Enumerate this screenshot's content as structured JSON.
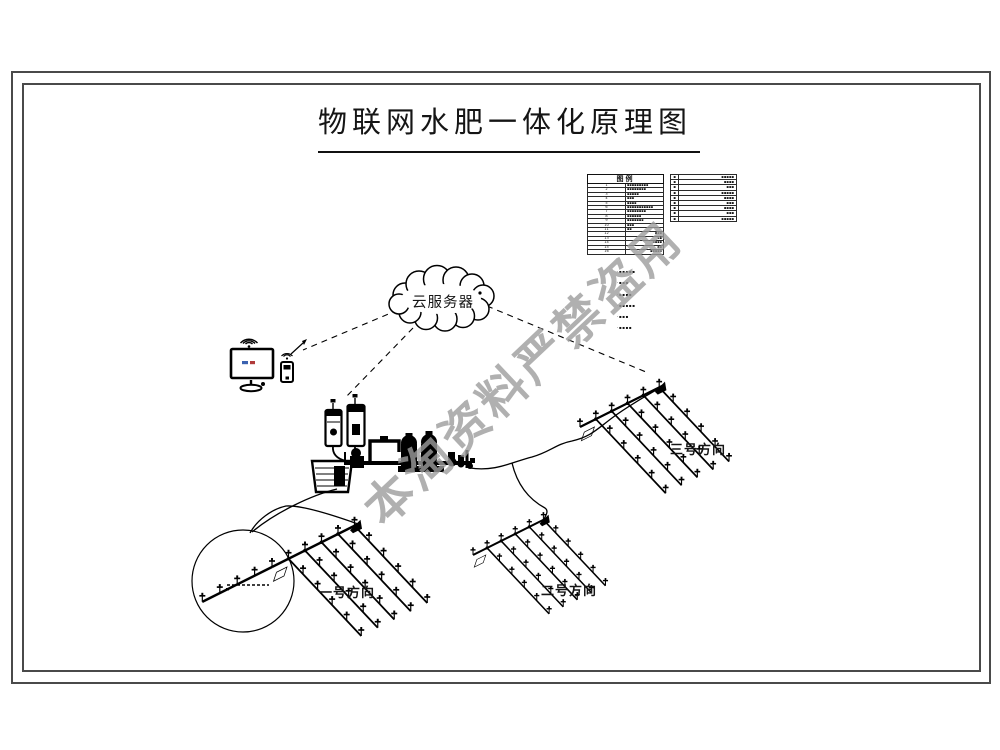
{
  "title": {
    "text": "物联网水肥一体化原理图"
  },
  "watermark": {
    "text": "本淘资料严禁盗用",
    "color": "rgba(156,156,156,0.8)"
  },
  "cloud": {
    "label": "云服务器"
  },
  "fields": {
    "one": "一号方向",
    "two": "二号方向",
    "three": "三号方向"
  },
  "colors": {
    "line": "#000000",
    "frame": "#4a4a4a",
    "screen_mark_blue": "#3a62b0",
    "screen_mark_red": "#b03a3a"
  },
  "legend_left": {
    "title": "图例",
    "rows": [
      {
        "no": "1",
        "label": "▪▪▪▪▪▪▪▪▪"
      },
      {
        "no": "2",
        "label": "▪▪▪▪▪▪▪▪"
      },
      {
        "no": "3",
        "label": "▪▪▪▪▪"
      },
      {
        "no": "4",
        "label": "▪▪▪"
      },
      {
        "no": "5",
        "label": "▪▪▪▪"
      },
      {
        "no": "6",
        "label": "▪▪▪▪▪▪▪▪▪▪▪"
      },
      {
        "no": "7",
        "label": "▪▪▪▪▪▪▪▪"
      },
      {
        "no": "8",
        "label": "▪▪▪▪▪▪"
      },
      {
        "no": "9",
        "label": "▪▪▪▪▪▪▪"
      },
      {
        "no": "10",
        "label": "▪▪▪"
      },
      {
        "no": "11",
        "label": "▪▪"
      },
      {
        "no": "12",
        "label": "▪▪▪"
      },
      {
        "no": "13",
        "label": "▪▪"
      },
      {
        "no": "14",
        "label": "▪▪▪▪"
      },
      {
        "no": "15",
        "label": "▪▪"
      },
      {
        "no": "16",
        "label": "▪▪▪▪▪"
      }
    ]
  },
  "legend_right": {
    "rows": [
      {
        "no": "▪",
        "label": "▪▪▪▪▪"
      },
      {
        "no": "▪",
        "label": "▪▪▪▪"
      },
      {
        "no": "▪",
        "label": "▪▪▪"
      },
      {
        "no": "▪",
        "label": "▪▪▪▪▪"
      },
      {
        "no": "▪",
        "label": "▪▪▪▪"
      },
      {
        "no": "▪",
        "label": "▪▪▪"
      },
      {
        "no": "▪",
        "label": "▪▪▪▪"
      },
      {
        "no": "▪",
        "label": "▪▪▪"
      },
      {
        "no": "▪",
        "label": "▪▪▪▪▪"
      }
    ]
  },
  "notes": [
    "·▪▪▪▪▪",
    "·▪▪▪",
    "·▪▪▪▪",
    "·▪▪▪▪▪",
    "·▪▪▪",
    "·▪▪▪▪"
  ]
}
